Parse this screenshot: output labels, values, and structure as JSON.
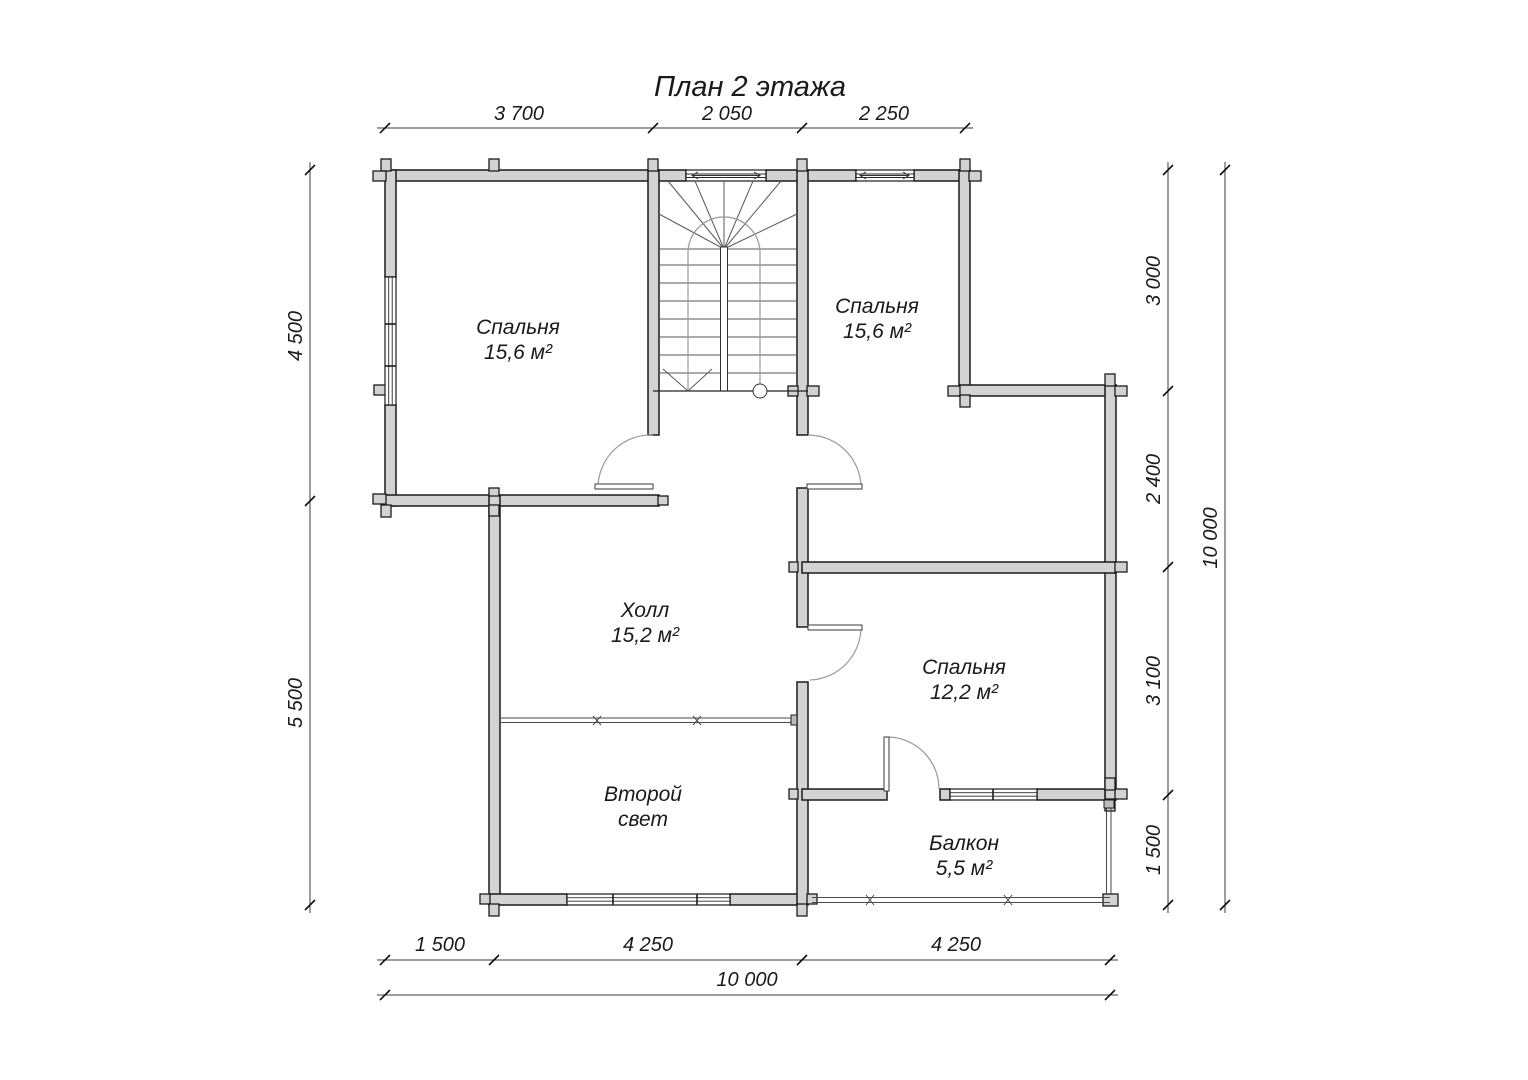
{
  "title": "План 2 этажа",
  "colors": {
    "wall_fill": "#d3d3d3",
    "line": "#1b1b1b",
    "dim_line": "#3d3d3d"
  },
  "rooms": {
    "bedroom_left": {
      "name": "Спальня",
      "area": "15,6 м²"
    },
    "bedroom_right": {
      "name": "Спальня",
      "area": "15,6 м²"
    },
    "hall": {
      "name": "Холл",
      "area": "15,2 м²"
    },
    "bedroom_small": {
      "name": "Спальня",
      "area": "12,2 м²"
    },
    "second_light": {
      "line1": "Второй",
      "line2": "свет"
    },
    "balcony": {
      "name": "Балкон",
      "area": "5,5 м²"
    }
  },
  "dimensions": {
    "top": [
      "3 700",
      "2 050",
      "2 250"
    ],
    "left": [
      "4 500",
      "5 500"
    ],
    "right": [
      "3 000",
      "2 400",
      "3 100",
      "1 500"
    ],
    "right_total": "10 000",
    "bottom": [
      "1 500",
      "4 250",
      "4 250"
    ],
    "bottom_total": "10 000"
  }
}
